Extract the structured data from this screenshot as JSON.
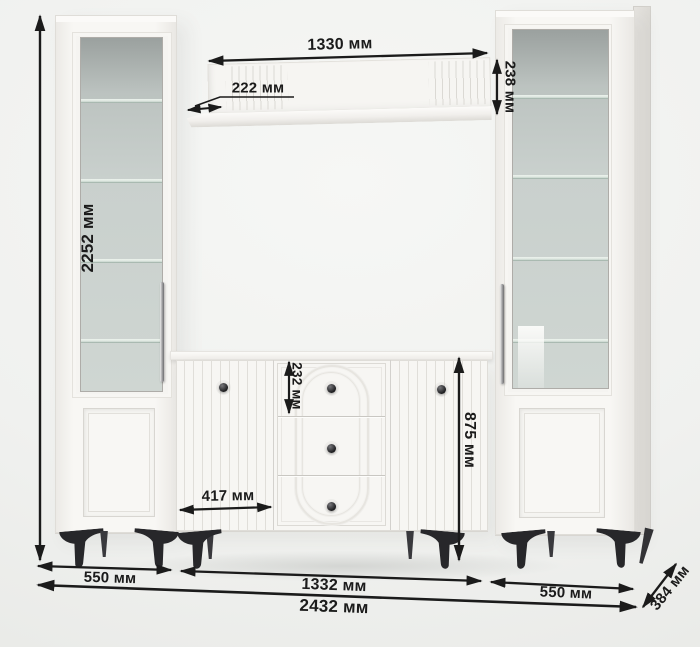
{
  "diagram": {
    "description": "Wall unit furniture dimensions diagram",
    "labels": {
      "total_height": "2252 мм",
      "shelf_width": "1330 мм",
      "shelf_depth": "222 мм",
      "shelf_panel_height": "238 мм",
      "top_drawer_height": "232 мм",
      "tv_stand_height": "875 мм",
      "stand_door_width": "417 мм",
      "left_cabinet_width": "550 мм",
      "tv_stand_width": "1332 мм",
      "right_cabinet_width": "550 мм",
      "total_width": "2432 мм",
      "cabinet_depth": "384 мм"
    },
    "colors": {
      "background": "#eff0ee",
      "furniture_white": "#f7f6f3",
      "glass": "#c9d0cd",
      "legs": "#27272a",
      "dimension_lines": "#1b1b1b"
    }
  }
}
